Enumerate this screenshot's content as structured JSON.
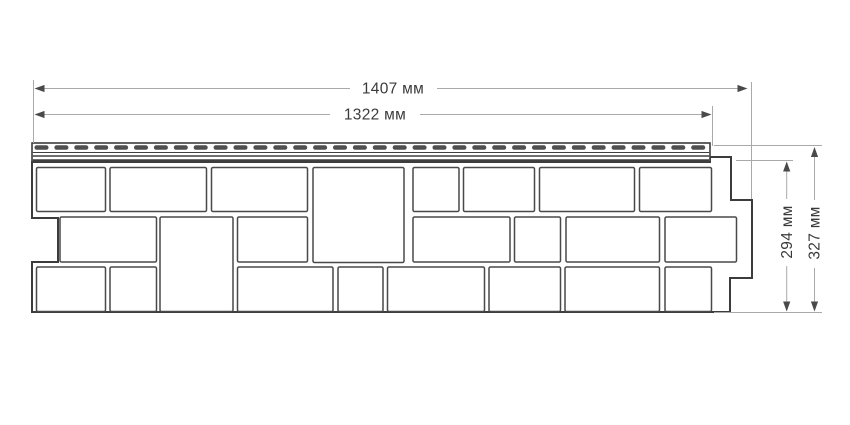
{
  "diagram": {
    "kind": "facade-panel-dimensional-drawing",
    "units": "мм"
  },
  "dimensions": {
    "width_total": {
      "label": "1407 мм",
      "value_mm": 1407
    },
    "width_nominal": {
      "label": "1322 мм",
      "value_mm": 1322
    },
    "height_nominal": {
      "label": "294 мм",
      "value_mm": 294
    },
    "height_total": {
      "label": "327 мм",
      "value_mm": 327
    }
  },
  "colors": {
    "background": "#ffffff",
    "panel_outline": "#3c3c3c",
    "block_stroke": "#494949",
    "slot_fill": "#4f4f4f",
    "dimension_line": "#a9a9a9",
    "dimension_arrow": "#4a4a4a",
    "dimension_text": "#3a3a3a"
  },
  "geometry": {
    "outline_path": "M32 162 H710 V157 H731 V200 H752 V278 H730 V312 H32 V262 H58 V218 H32 Z",
    "strip": {
      "x": 32,
      "y": 143,
      "w": 678,
      "h": 19
    },
    "strip_lines": [
      {
        "y": 152.5,
        "t": 1.0
      },
      {
        "y": 156.0,
        "t": 1.6
      },
      {
        "y": 160.6,
        "t": 2.6
      }
    ],
    "slots": {
      "x0": 34.5,
      "y": 145.2,
      "w": 14,
      "h": 4.6,
      "pitch": 19.9,
      "count": 34,
      "rx": 2.2
    },
    "blocks": [
      [
        36.5,
        167.5,
        69,
        44
      ],
      [
        110,
        167.5,
        96.5,
        44
      ],
      [
        211.5,
        167.5,
        96,
        44
      ],
      [
        313,
        167.5,
        91,
        95
      ],
      [
        413,
        167.5,
        46,
        44
      ],
      [
        463.5,
        167.5,
        71,
        44
      ],
      [
        539.5,
        167.5,
        95,
        44
      ],
      [
        639.5,
        167.5,
        72,
        44
      ],
      [
        60,
        217,
        96.5,
        45
      ],
      [
        160,
        217,
        73,
        94.5
      ],
      [
        237.5,
        217,
        70,
        45
      ],
      [
        413,
        217,
        97,
        45
      ],
      [
        514.5,
        217,
        46,
        45
      ],
      [
        566,
        217,
        93.5,
        45
      ],
      [
        665,
        217,
        71.5,
        45
      ],
      [
        36.5,
        267,
        69,
        44.5
      ],
      [
        110,
        267,
        46.5,
        44.5
      ],
      [
        237.5,
        267,
        95.5,
        44.5
      ],
      [
        338,
        267,
        45,
        44.5
      ],
      [
        387.5,
        267,
        97,
        44.5
      ],
      [
        489,
        267,
        71.5,
        44.5
      ],
      [
        565,
        267,
        94.5,
        44.5
      ],
      [
        665,
        267,
        46.5,
        44.5
      ]
    ],
    "dim_lines": [
      [
        36,
        88.5,
        350,
        88.5
      ],
      [
        437,
        88.5,
        746,
        88.5
      ],
      [
        36,
        114.5,
        330,
        114.5
      ],
      [
        420,
        114.5,
        710,
        114.5
      ],
      [
        33.5,
        80,
        33.5,
        143
      ],
      [
        712.5,
        106,
        712.5,
        146
      ],
      [
        751.5,
        82,
        751.5,
        199
      ],
      [
        714,
        145.5,
        822,
        145.5
      ],
      [
        736,
        160.5,
        793,
        160.5
      ],
      [
        714,
        312.5,
        822,
        312.5
      ],
      [
        786.7,
        163,
        786.7,
        199
      ],
      [
        786.7,
        266,
        786.7,
        310
      ],
      [
        814.5,
        148.5,
        814.5,
        200
      ],
      [
        814.5,
        268,
        814.5,
        310
      ]
    ],
    "arrows": [
      [
        34.5,
        88.5,
        "left"
      ],
      [
        747.5,
        88.5,
        "right"
      ],
      [
        34.5,
        114.5,
        "left"
      ],
      [
        711.5,
        114.5,
        "right"
      ],
      [
        786.7,
        161.5,
        "up"
      ],
      [
        786.7,
        311.5,
        "down"
      ],
      [
        814.5,
        147,
        "up"
      ],
      [
        814.5,
        311.5,
        "down"
      ]
    ]
  }
}
